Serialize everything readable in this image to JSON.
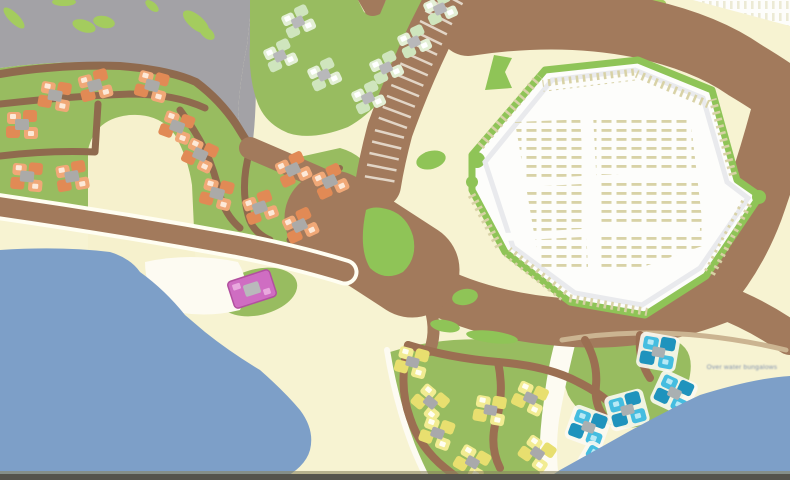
{
  "map": {
    "beach_label": "Over water bungalows",
    "colors": {
      "pavement_gray": "#a3a2a6",
      "bush_green": "#a4cc5e",
      "lawn_green": "#98bc60",
      "hedge_green": "#8fc457",
      "road_brown": "#a27a5c",
      "path_brown": "#8f6a4e",
      "peninsula_path_brown": "#9b6f52",
      "sand_beige": "#f7f3d2",
      "dune_beige": "#f6f1cd",
      "water_blue": "#7d9fc8",
      "parking_white": "#fdfdfb",
      "stall_tan": "#d8d2a6",
      "aisle_gray": "#e9eaed",
      "walkway_white": "#fdfbf2",
      "house_orange": "#e18a55",
      "house_pale_green": "#cfe5bd",
      "house_yellow": "#e8df6f",
      "house_cyan": "#35b5dc",
      "building_pink": "#cf6dc2",
      "bottom_bar": "#55544c"
    },
    "clusters": [
      {
        "id": "orange-villas",
        "symbol": "sym-orange",
        "color": "#e18a55",
        "houses": [
          [
            55,
            96,
            10
          ],
          [
            95,
            86,
            -15
          ],
          [
            152,
            86,
            15
          ],
          [
            22,
            125,
            0
          ],
          [
            177,
            127,
            20
          ],
          [
            27,
            177,
            5
          ],
          [
            72,
            177,
            -10
          ],
          [
            200,
            155,
            25
          ],
          [
            217,
            194,
            15
          ],
          [
            260,
            208,
            -20
          ],
          [
            293,
            170,
            -25
          ],
          [
            330,
            182,
            -25
          ],
          [
            300,
            226,
            -25
          ]
        ]
      },
      {
        "id": "green-lodges",
        "symbol": "sym-pale",
        "color": "#cfe5bd",
        "houses": [
          [
            298,
            22,
            -25
          ],
          [
            280,
            56,
            -25
          ],
          [
            324,
            75,
            -25
          ],
          [
            368,
            98,
            -25
          ],
          [
            414,
            42,
            -25
          ],
          [
            386,
            68,
            -25
          ],
          [
            440,
            9,
            -25
          ]
        ]
      },
      {
        "id": "yellow-cottages",
        "symbol": "sym-yellow",
        "color": "#e8df6f",
        "houses": [
          [
            412,
            362,
            15
          ],
          [
            430,
            402,
            40
          ],
          [
            437,
            433,
            20
          ],
          [
            472,
            462,
            30
          ],
          [
            490,
            410,
            10
          ],
          [
            530,
            398,
            25
          ],
          [
            537,
            453,
            35
          ]
        ]
      },
      {
        "id": "cyan-bungalows",
        "symbol": "sym-cyan",
        "color": "#35b5dc",
        "houses": [
          [
            588,
            427,
            20
          ],
          [
            627,
            410,
            -15
          ],
          [
            658,
            352,
            10
          ],
          [
            674,
            393,
            25
          ],
          [
            598,
            464,
            30
          ]
        ]
      }
    ],
    "landmarks": {
      "pink_building": {
        "x": 252,
        "y": 289,
        "rotation": -18,
        "color": "#cf6dc2"
      }
    }
  }
}
